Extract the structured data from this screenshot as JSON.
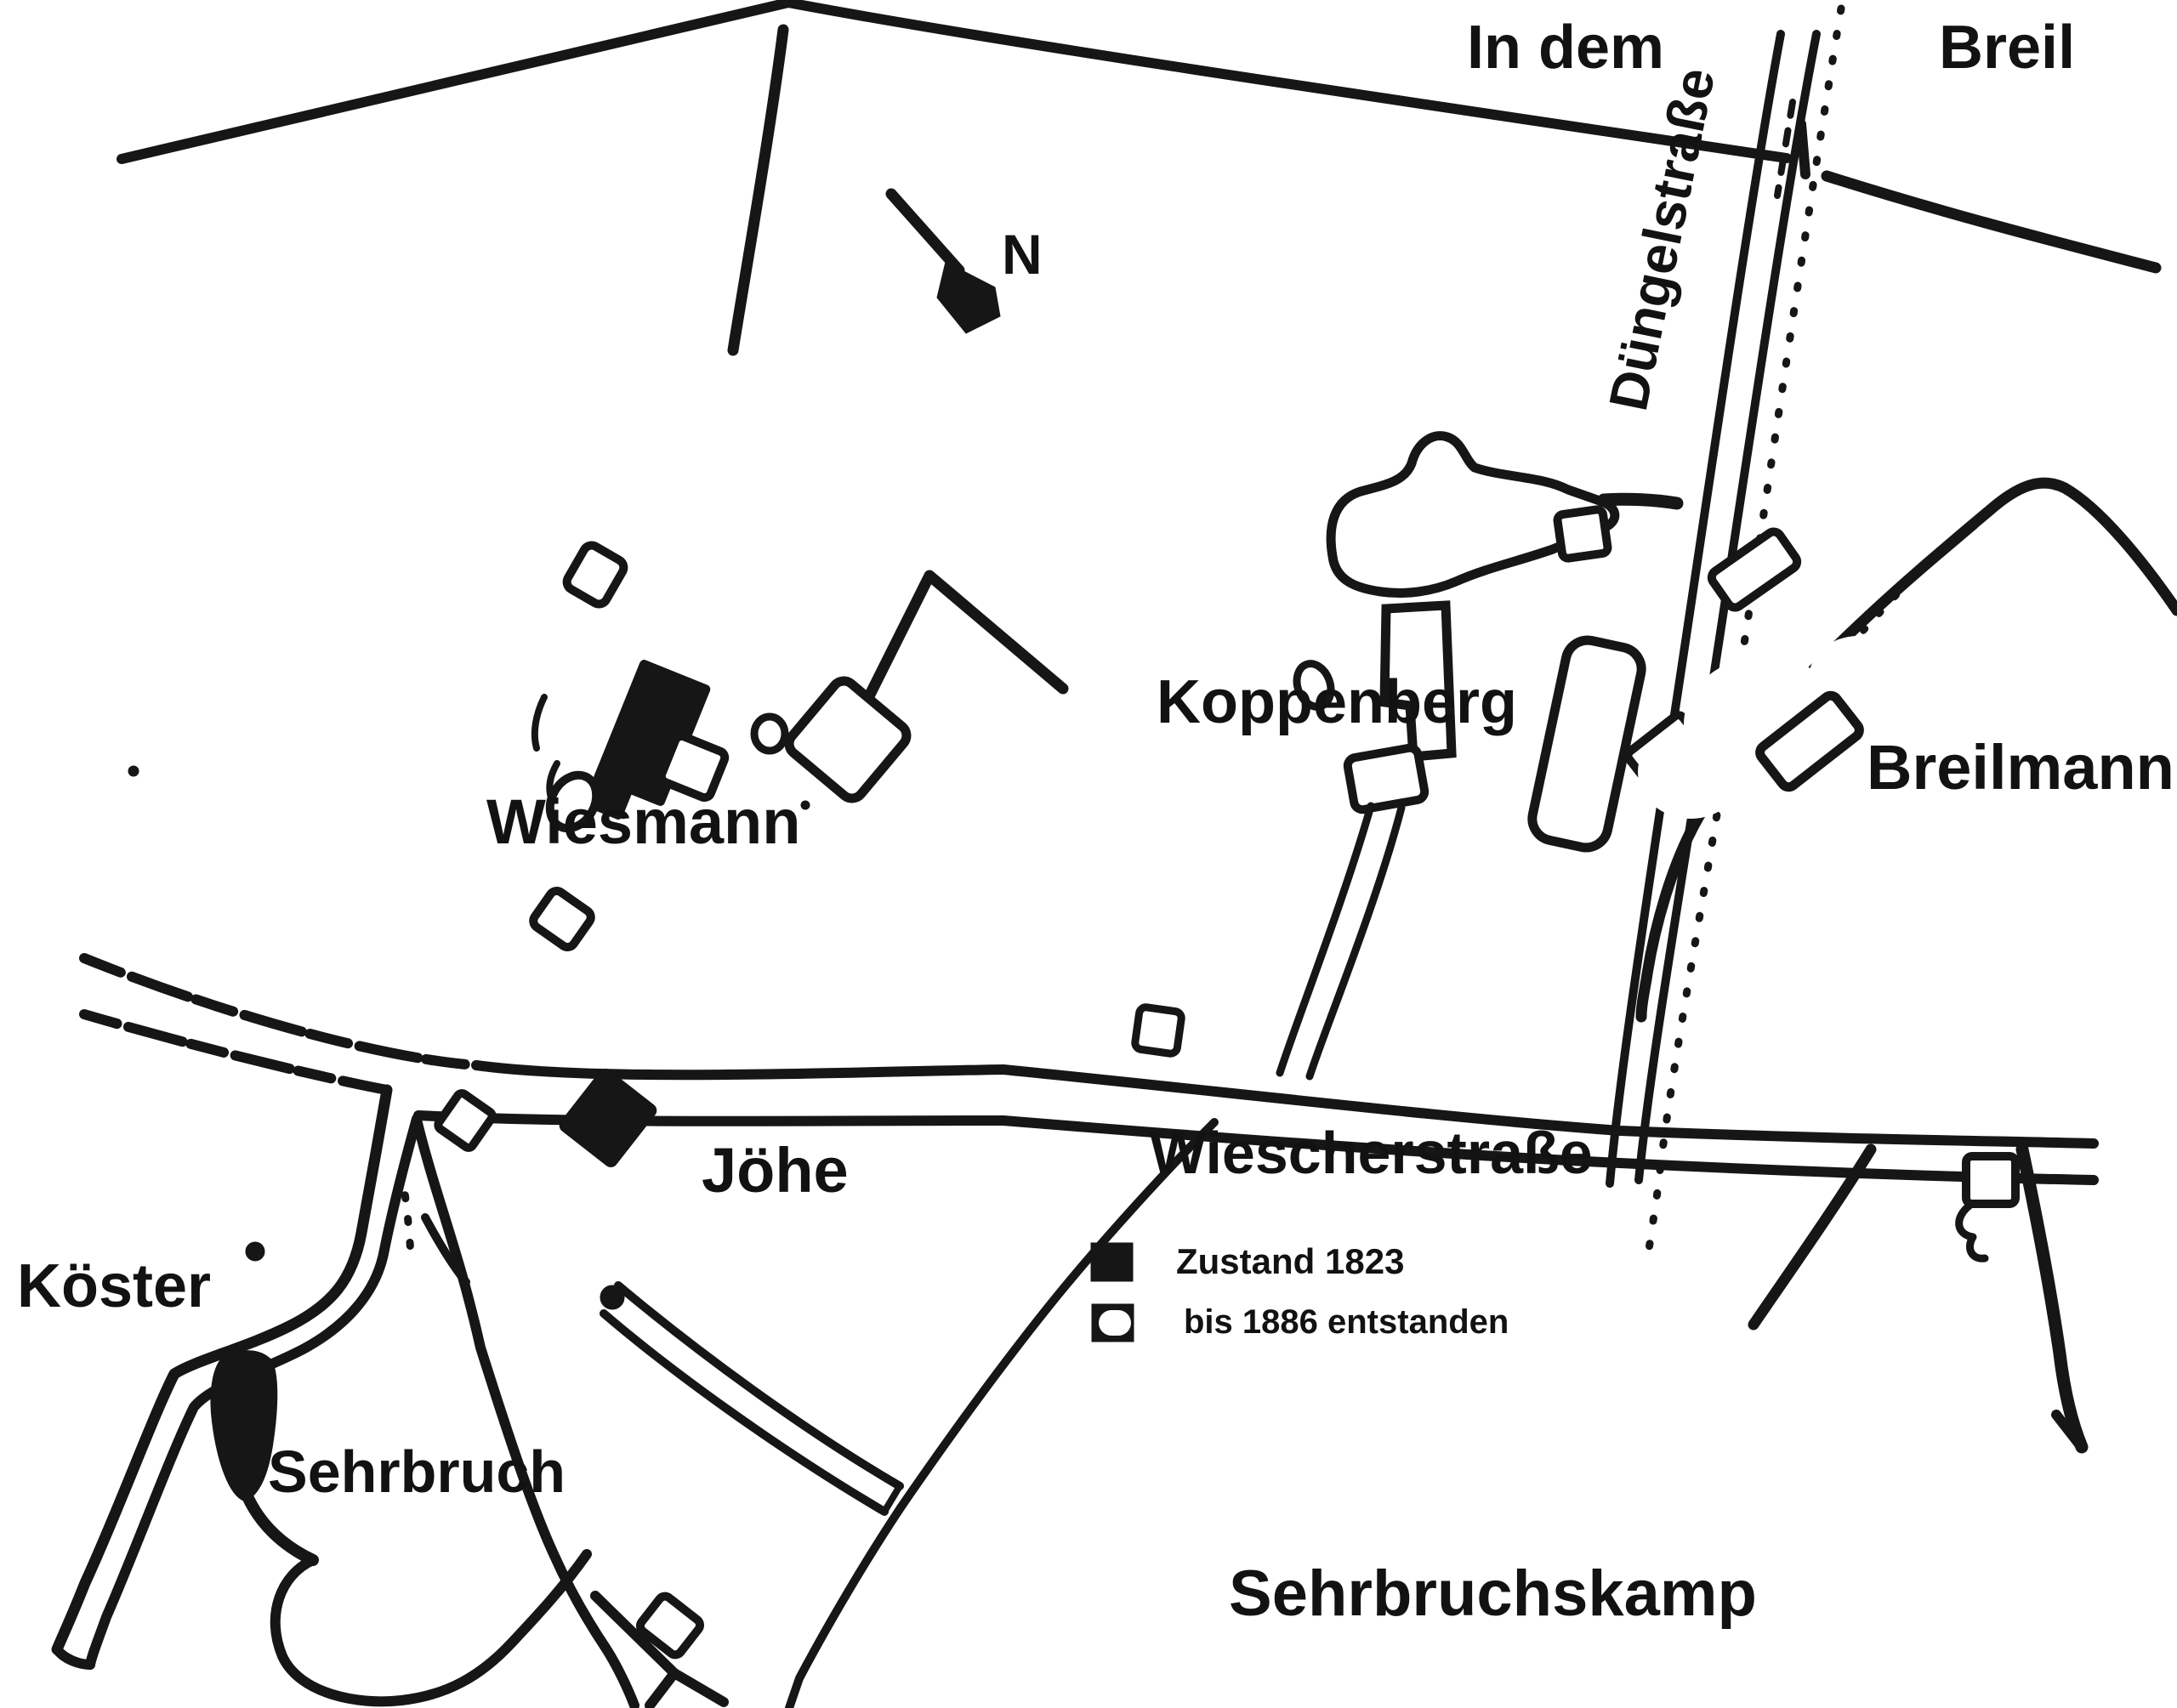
{
  "map": {
    "kind": "historical settlement sketch map",
    "colors": {
      "ink": "#161616",
      "background": "#ffffff"
    },
    "area_labels": {
      "in_dem": "In dem",
      "breil": "Breil",
      "sehrbruchskamp": "Sehrbruchskamp"
    },
    "street_labels": {
      "duengelstrasse": "Düngelstraße",
      "wiescherstrasse": "Wiescherstraße"
    },
    "farm_labels": {
      "koppenberg": "Koppenberg",
      "breilmann": "Breilmann",
      "wiesmann": "Wiesmann",
      "joehe": "Jöhe",
      "koester": "Köster",
      "sehrbruch": "Sehrbruch"
    },
    "compass": {
      "north_label": "N"
    },
    "legend": {
      "items": [
        {
          "symbol": "filled-square",
          "label": "Zustand 1823"
        },
        {
          "symbol": "outlined-square",
          "label": "bis 1886 entstanden"
        }
      ]
    }
  }
}
